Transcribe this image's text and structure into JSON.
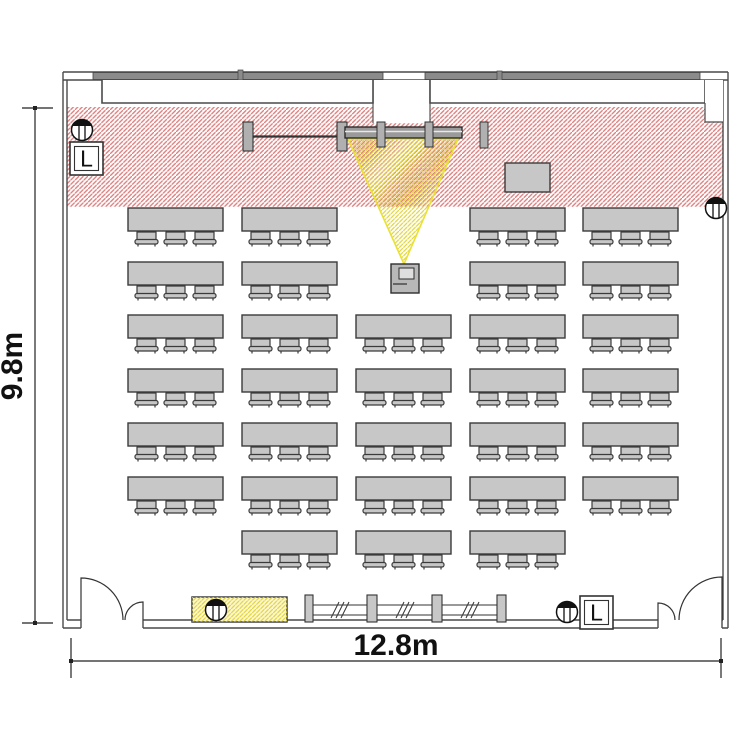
{
  "page": {
    "type": "seminar room floor plan",
    "background": "#ffffff"
  },
  "dimensions": {
    "height_label": "9.8m",
    "width_label": "12.8m"
  },
  "switch_panels": [
    {
      "label": "L"
    },
    {
      "label": "L"
    }
  ],
  "seating": {
    "grid": [
      [
        1,
        1,
        0,
        1,
        1
      ],
      [
        1,
        1,
        0,
        1,
        1
      ],
      [
        1,
        1,
        1,
        1,
        1
      ],
      [
        1,
        1,
        1,
        1,
        1
      ],
      [
        1,
        1,
        1,
        1,
        1
      ],
      [
        1,
        1,
        1,
        1,
        1
      ],
      [
        0,
        1,
        1,
        1,
        0
      ]
    ],
    "chairs_per_table": 3,
    "tables_total": 31,
    "seats_total": 93
  },
  "equipment": {
    "speakers": 4,
    "projector": 1,
    "projection_screen": 1,
    "lectern": 1,
    "double_doors": 2,
    "whiteboard_rails": 2,
    "window_bays": 3,
    "operator_desk": 1
  },
  "colors": {
    "wall": "#4a4a4a",
    "table_fill": "#c7c7c7",
    "table_stroke": "#3b3b3b",
    "stage_hatch": "#dc7c7c",
    "beam_hatch": "#e0d435",
    "beam_outline": "#eae135",
    "desk_hatch_bg": "#fdf7d6",
    "whiteboard_bar": "#8b8b8b"
  }
}
